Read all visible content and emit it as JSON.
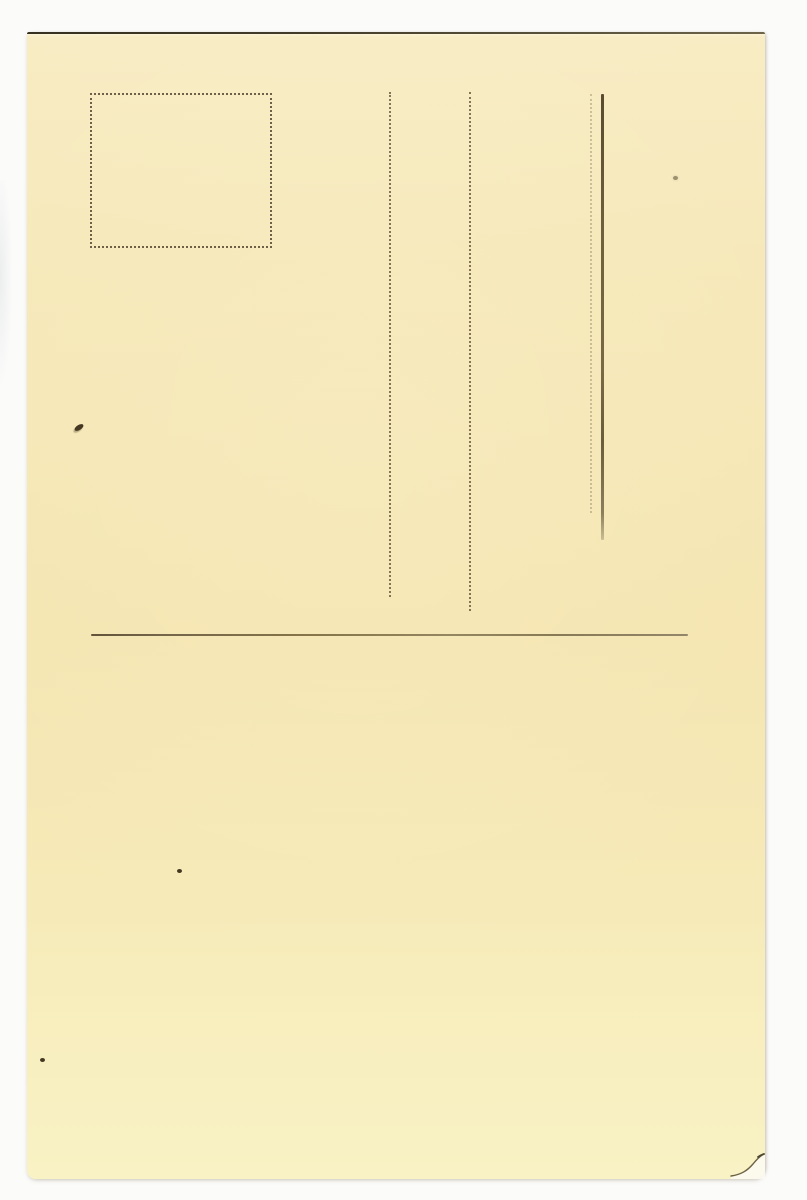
{
  "meta": {
    "description": "Back (address side) of a blank vintage cream postcard photographed on a white background; no printed or written text is visible"
  },
  "colors": {
    "page-bg": "#fbfbfa",
    "card-top": "#f8ecc4",
    "card-mid": "#f5e6b2",
    "card-bottom": "#f8f2c4",
    "edge-dark": "#35301f",
    "dot-line": "#56462e",
    "rule-line": "#857448",
    "solid-line": "#6e5f3d",
    "speck": "#443823",
    "crease": "#6b6143"
  },
  "postcard": {
    "stamp_box": "empty dotted rectangle for postage stamp, top left",
    "address_lines": [
      "dotted vertical guide line",
      "dotted vertical guide line",
      "faint dotted vertical guide line",
      "solid dark vertical line"
    ],
    "message_rule": "long thin horizontal divider line across the card",
    "blemishes": [
      "dark ink speck left middle",
      "small dark speck lower middle",
      "faint brown speck upper right",
      "small dark speck at left edge lower area",
      "bent and creased bottom-right corner"
    ]
  }
}
